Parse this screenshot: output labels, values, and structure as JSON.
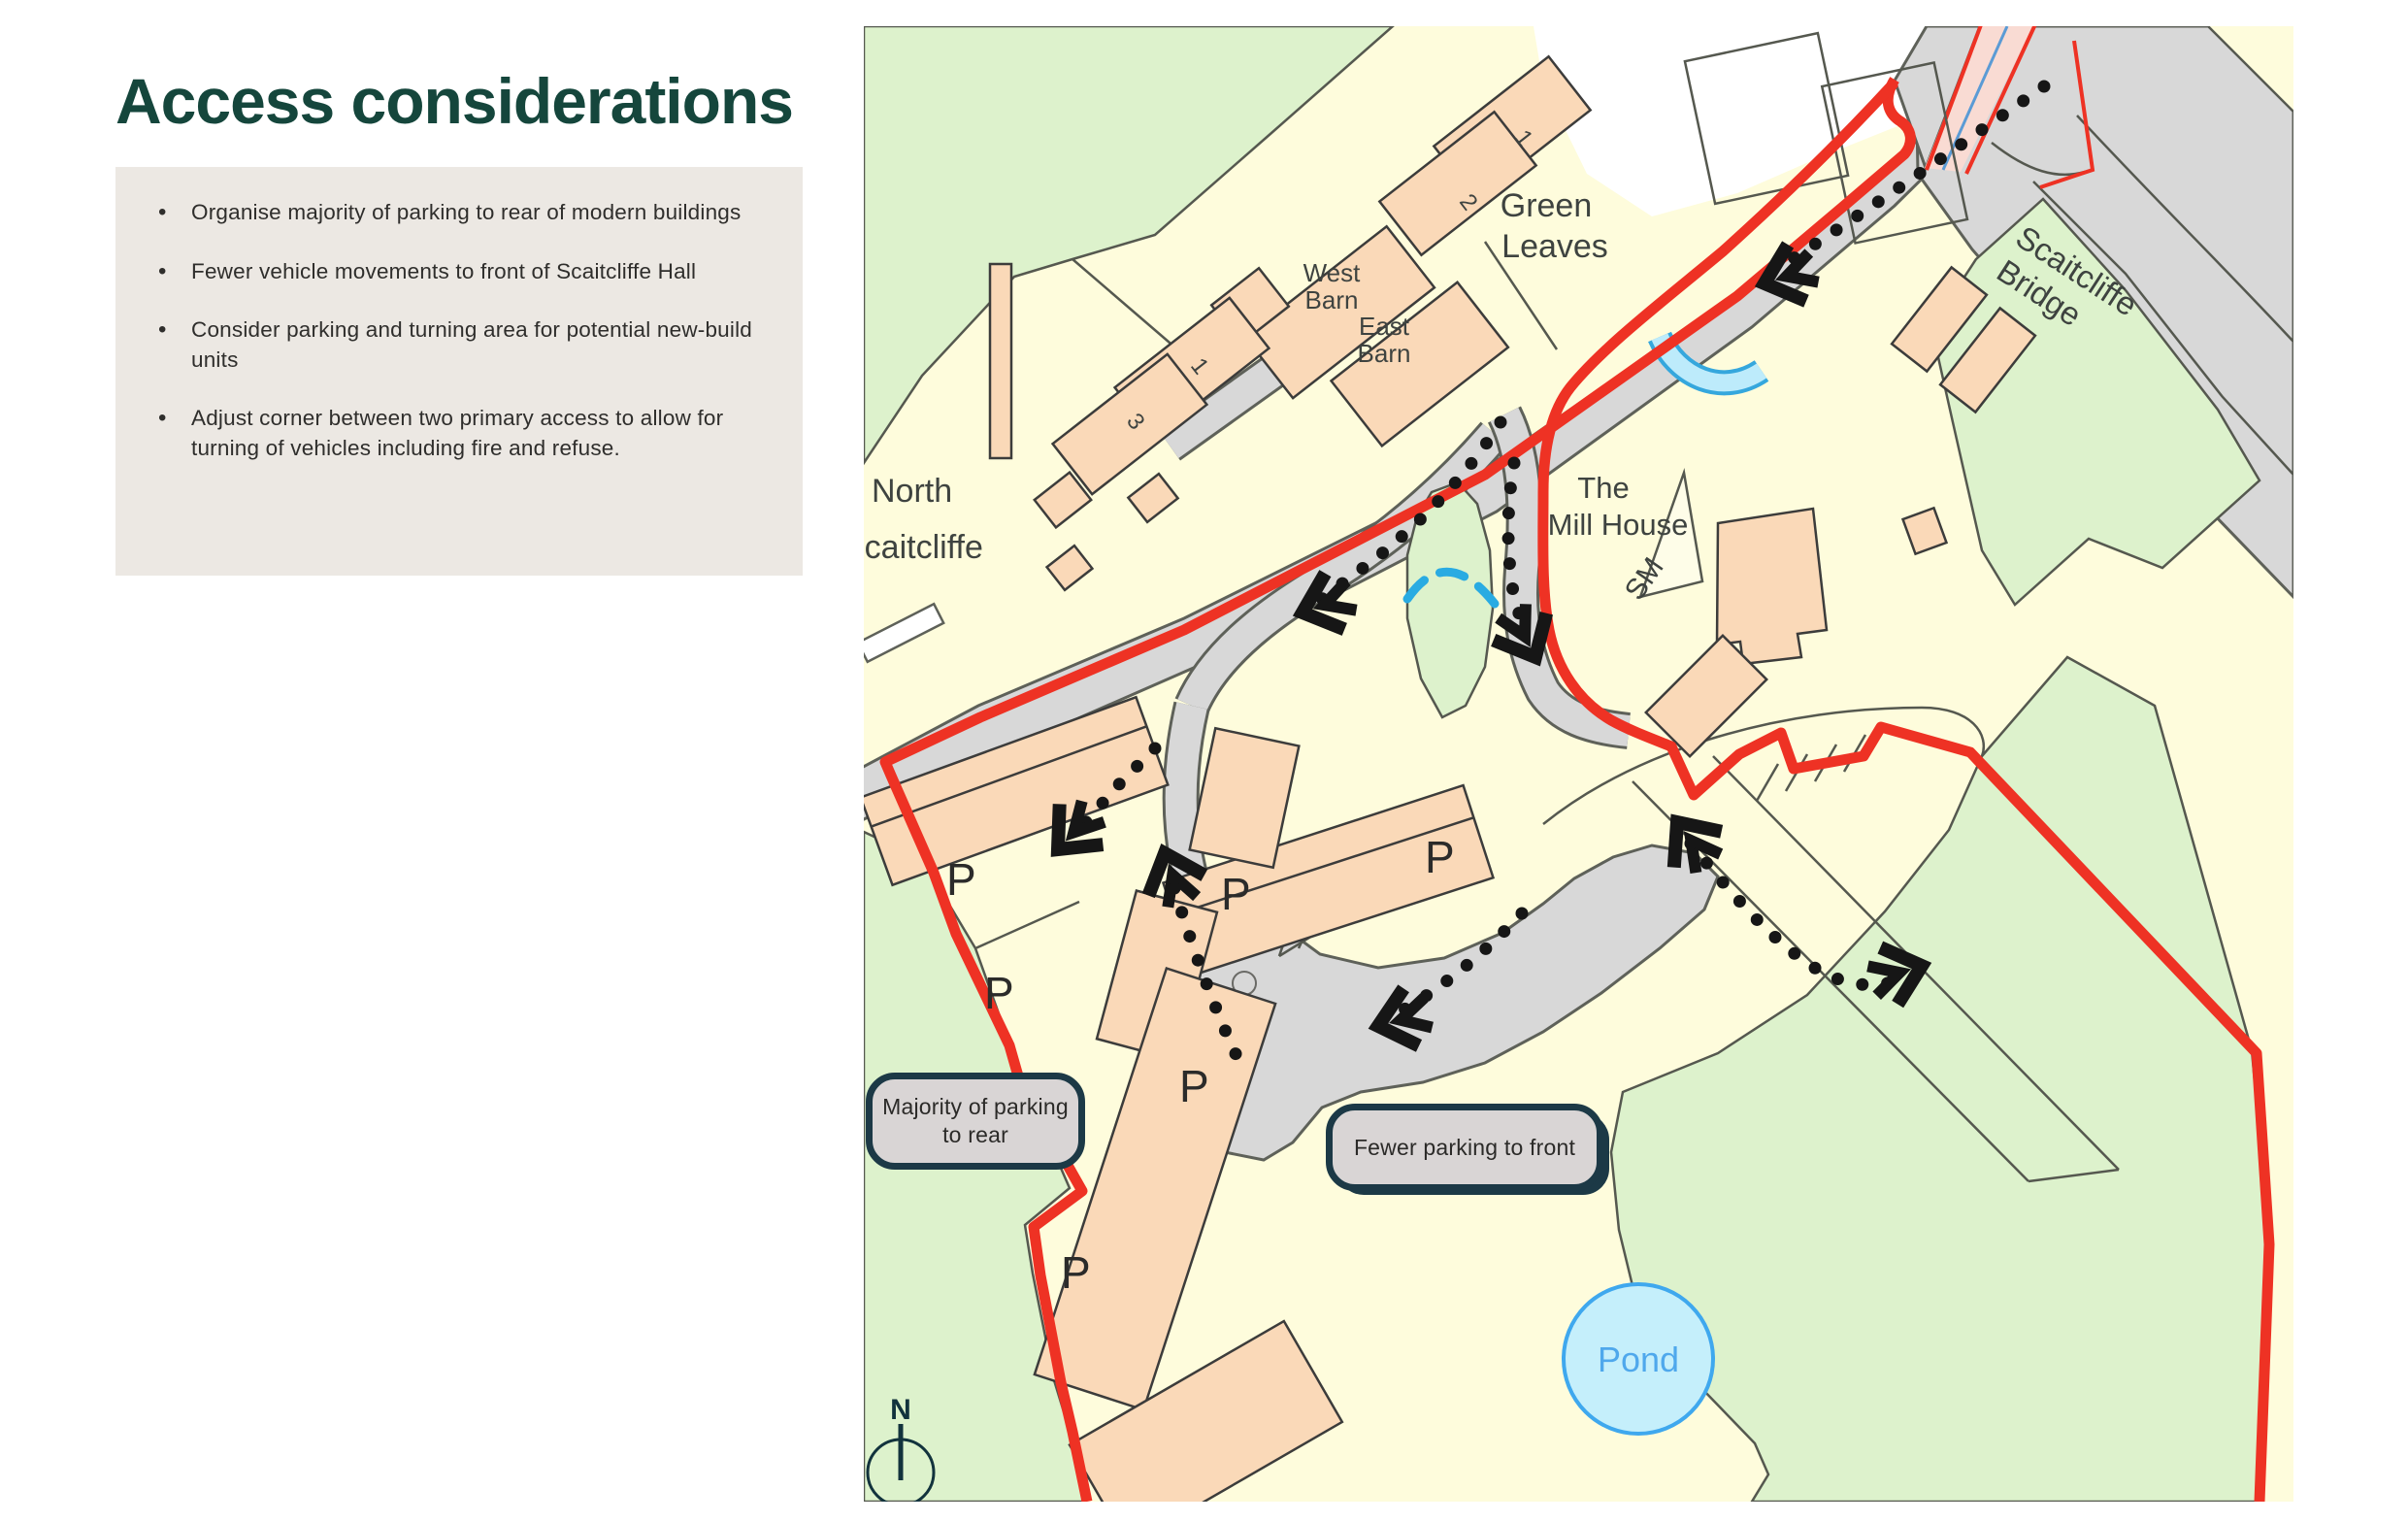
{
  "page": {
    "title": "Access considerations"
  },
  "notes": {
    "bullets": [
      "Organise majority of parking to rear of modern buildings",
      "Fewer vehicle movements to front of Scaitcliffe Hall",
      "Consider parking and turning area for potential new-build units",
      "Adjust corner between two primary access to allow for turning of vehicles including fire and refuse."
    ]
  },
  "map": {
    "labels": {
      "green_leaves_1": "Green",
      "green_leaves_2": "Leaves",
      "west_barn_1": "West",
      "west_barn_2": "Barn",
      "east_barn_1": "East",
      "east_barn_2": "Barn",
      "north_scaitcliffe_1": "North",
      "north_scaitcliffe_2": "Scaitcliffe",
      "mill_house_1": "The",
      "mill_house_2": "Mill House",
      "sm": "SM",
      "bridge_1": "Scaitcliffe",
      "bridge_2": "Bridge",
      "pond": "Pond",
      "parking": "P",
      "num_1": "1",
      "num_2": "2",
      "num_3": "3",
      "compass_north": "N"
    },
    "callouts": {
      "rear": "Majority of parking to rear",
      "front": "Fewer parking to front"
    },
    "colors": {
      "boundary_red": "#EE3224",
      "field_green": "#DDF2CC",
      "road_grey": "#D8D8D8",
      "building_peach": "#FAD9B8",
      "water_blue": "#BDEBFB",
      "callout_border": "#1C3946",
      "title_green": "#15463C"
    }
  }
}
